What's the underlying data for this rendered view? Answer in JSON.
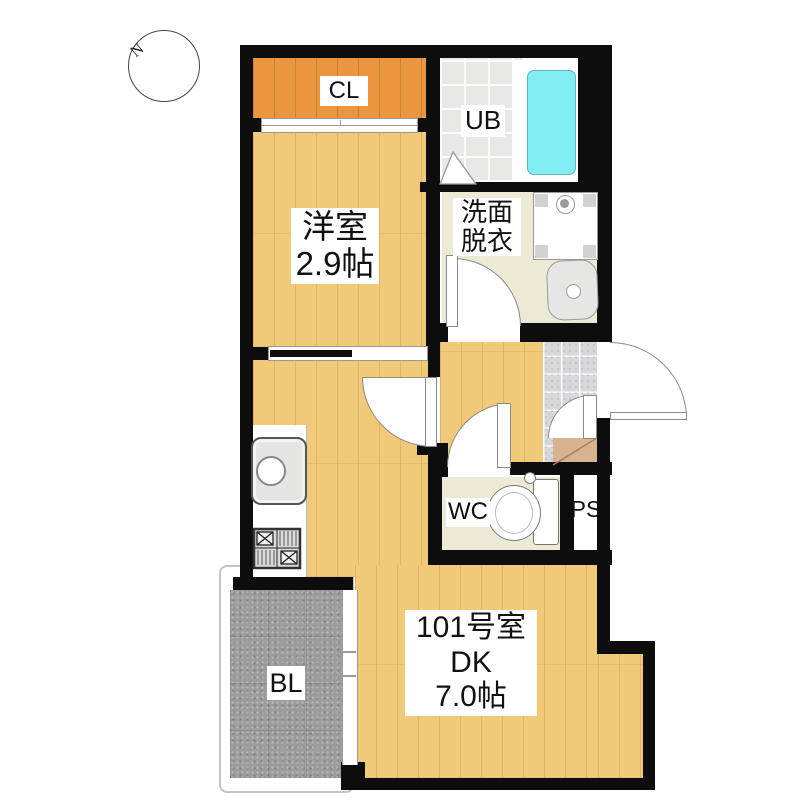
{
  "title": "apartment-floor-plan",
  "compass": {
    "label": "N"
  },
  "rooms": {
    "closet": {
      "label": "CL"
    },
    "unit_bath": {
      "label": "UB"
    },
    "western_room": {
      "name": "洋室",
      "area": "2.9帖"
    },
    "washroom": {
      "line1": "洗面",
      "line2": "脱衣"
    },
    "toilet": {
      "label": "WC"
    },
    "pipe_space": {
      "label": "PS"
    },
    "dining_kitchen": {
      "unit": "101号室",
      "type": "DK",
      "area": "7.0帖"
    },
    "balcony": {
      "label": "BL"
    }
  },
  "fixtures": [
    "bathtub",
    "washing-machine-pan",
    "washbasin",
    "toilet",
    "kitchen-sink",
    "gas-stove",
    "entrance-step",
    "sliding-closet-door",
    "balcony-window",
    "entrance-door"
  ],
  "colors": {
    "wall": "#0d0d0d",
    "wood_floor": "#f0ca79",
    "closet_floor": "#e9963e",
    "bath_tile": "#e8e8e6",
    "washroom_floor": "#ece9d4",
    "entrance_tile": "#d8d8dc",
    "step": "#d9b390",
    "balcony": "#9c9c9c",
    "bathtub": "#80eef2"
  }
}
